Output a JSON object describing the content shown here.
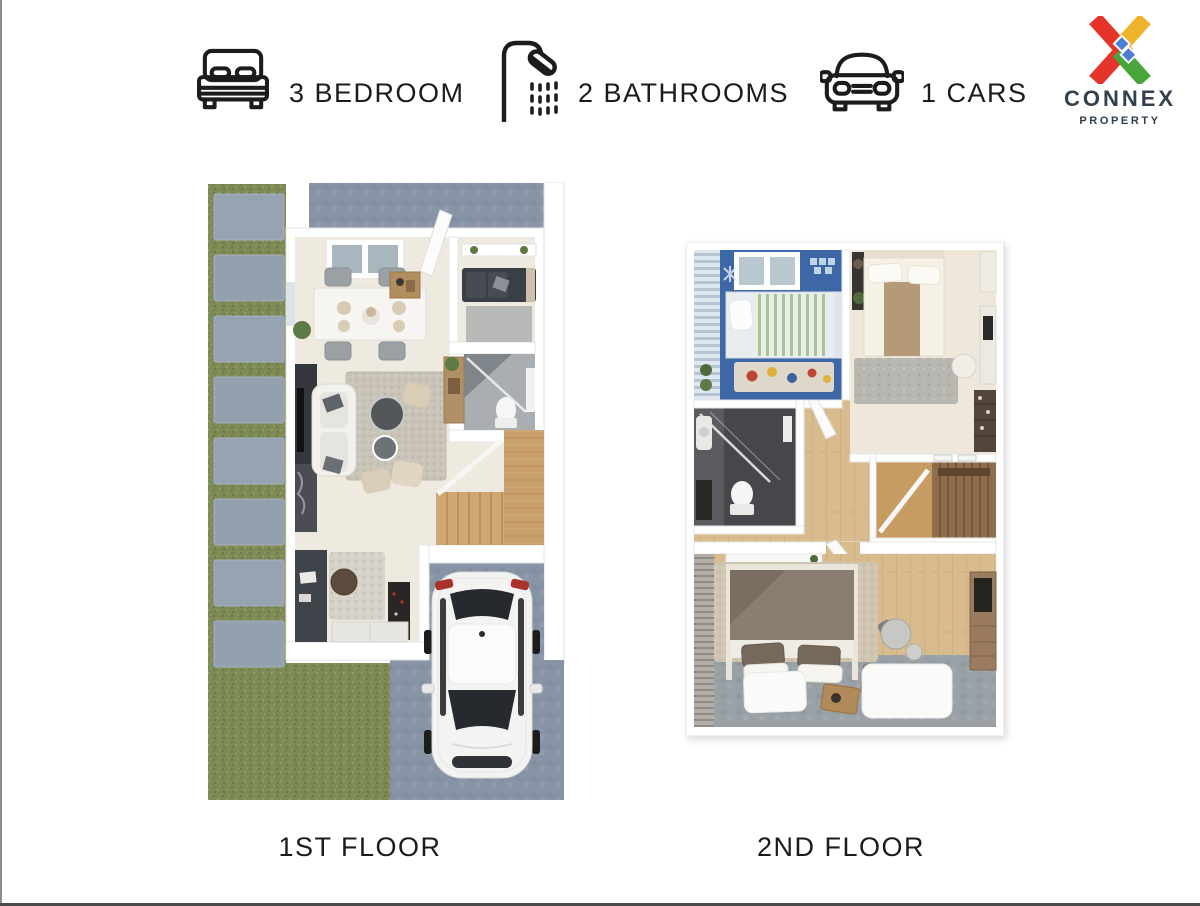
{
  "header": {
    "features": [
      {
        "icon": "bed-icon",
        "label": "3 BEDROOM"
      },
      {
        "icon": "shower-icon",
        "label": "2 BATHROOMS"
      },
      {
        "icon": "car-icon",
        "label": "1 CARS"
      }
    ],
    "logo": {
      "brand": "CONNEX",
      "tagline": "PROPERTY"
    }
  },
  "floors": [
    {
      "caption": "1ST FLOOR"
    },
    {
      "caption": "2ND FLOOR"
    }
  ],
  "palette": {
    "text": "#1b1b1b",
    "logo_red": "#e5352b",
    "logo_yellow": "#eeb32a",
    "logo_green": "#4aa43c",
    "logo_blue": "#4b7ed2",
    "logo_navy": "#32404f",
    "grass": "#7d8a55",
    "paver": "#97a3b0",
    "driveway": "#8794a5",
    "interior_floor": "#efeae0",
    "stair_wood": "#c9a06b",
    "hall_wood": "#d9bc8e",
    "blue_bedroom_floor": "#3e67a8",
    "bathroom_dark": "#46474a",
    "master_gray_floor": "#9aa1a6"
  }
}
